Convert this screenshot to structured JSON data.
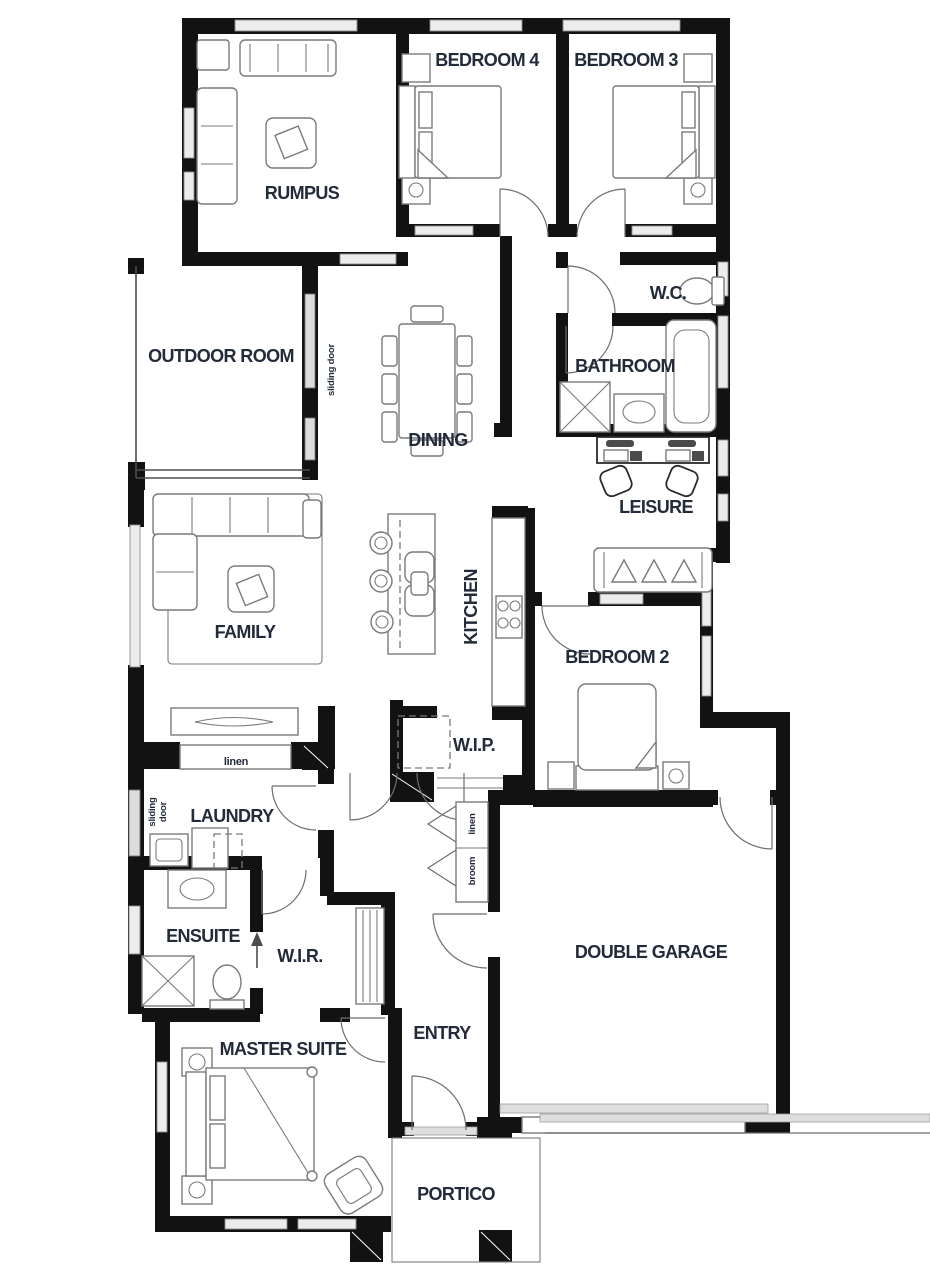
{
  "document": {
    "kind": "residential floor plan",
    "orientation": "portrait"
  },
  "colors": {
    "wall": "#121212",
    "label_text": "#232b3a",
    "furniture_line": "#7a7a7a",
    "window_fill": "#ececec",
    "background": "#ffffff"
  },
  "rooms": [
    {
      "label": "RUMPUS"
    },
    {
      "label": "BEDROOM 4"
    },
    {
      "label": "BEDROOM 3"
    },
    {
      "label": "OUTDOOR ROOM"
    },
    {
      "label": "W.C."
    },
    {
      "label": "BATHROOM"
    },
    {
      "label": "DINING"
    },
    {
      "label": "LEISURE"
    },
    {
      "label": "FAMILY"
    },
    {
      "label": "KITCHEN"
    },
    {
      "label": "BEDROOM 2"
    },
    {
      "label": "W.I.P."
    },
    {
      "label": "LAUNDRY"
    },
    {
      "label": "ENSUITE"
    },
    {
      "label": "W.I.R."
    },
    {
      "label": "MASTER SUITE"
    },
    {
      "label": "ENTRY"
    },
    {
      "label": "DOUBLE GARAGE"
    },
    {
      "label": "PORTICO"
    }
  ],
  "annotations": {
    "sliding_door": "sliding door",
    "sliding": "sliding",
    "door": "door",
    "linen": "linen",
    "linen2": "linen",
    "broom": "broom"
  }
}
